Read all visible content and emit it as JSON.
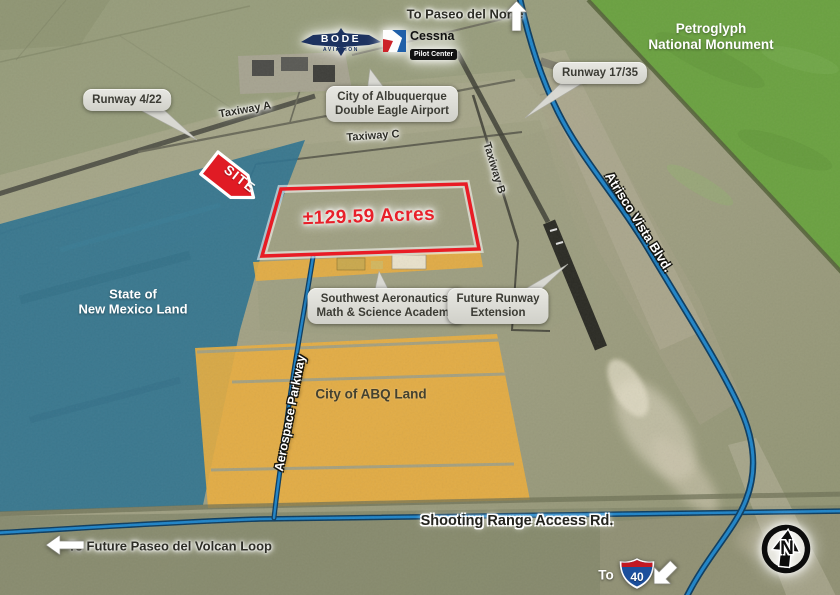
{
  "colors": {
    "site_red": "#e01b24",
    "overlay_orange": "#eaae3f",
    "overlay_teal": "#2f7390",
    "monument_green": "#6ba241",
    "road_blue": "#1f85c9",
    "label_pill": "#d9d9d3"
  },
  "logos": {
    "bode": {
      "name": "BODE",
      "sub": "AVIATION"
    },
    "cessna": {
      "name": "Cessna",
      "sub": "Pilot Center"
    }
  },
  "callouts": {
    "airport": {
      "line1": "City of Albuquerque",
      "line2": "Double Eagle Airport"
    },
    "runway_4_22": {
      "text": "Runway 4/22"
    },
    "runway_17_35": {
      "text": "Runway 17/35"
    },
    "academy": {
      "line1": "Southwest Aeronautics,",
      "line2": "Math & Science Academy"
    },
    "future_runway": {
      "line1": "Future Runway",
      "line2": "Extension"
    }
  },
  "taxiways": {
    "a": "Taxiway A",
    "b": "Taxiway B",
    "c": "Taxiway C"
  },
  "site": {
    "marker": "SITE",
    "acreage": "±129.59 Acres"
  },
  "areas": {
    "petroglyph": {
      "line1": "Petroglyph",
      "line2": "National Monument"
    },
    "state_land": {
      "line1": "State of",
      "line2": "New Mexico Land"
    },
    "abq_land": {
      "text": "City of ABQ Land"
    }
  },
  "roads": {
    "atrisco": "Atrisco Vista Blvd.",
    "aerospace": "Aerospace Parkway",
    "shooting_range": "Shooting Range Access Rd."
  },
  "directions": {
    "paseo_del_norte": "To Paseo del Norte",
    "paseo_del_volcan": "To Future Paseo del Volcan Loop",
    "i40_prefix": "To",
    "i40_route": "40"
  },
  "compass": {
    "north": "N"
  }
}
